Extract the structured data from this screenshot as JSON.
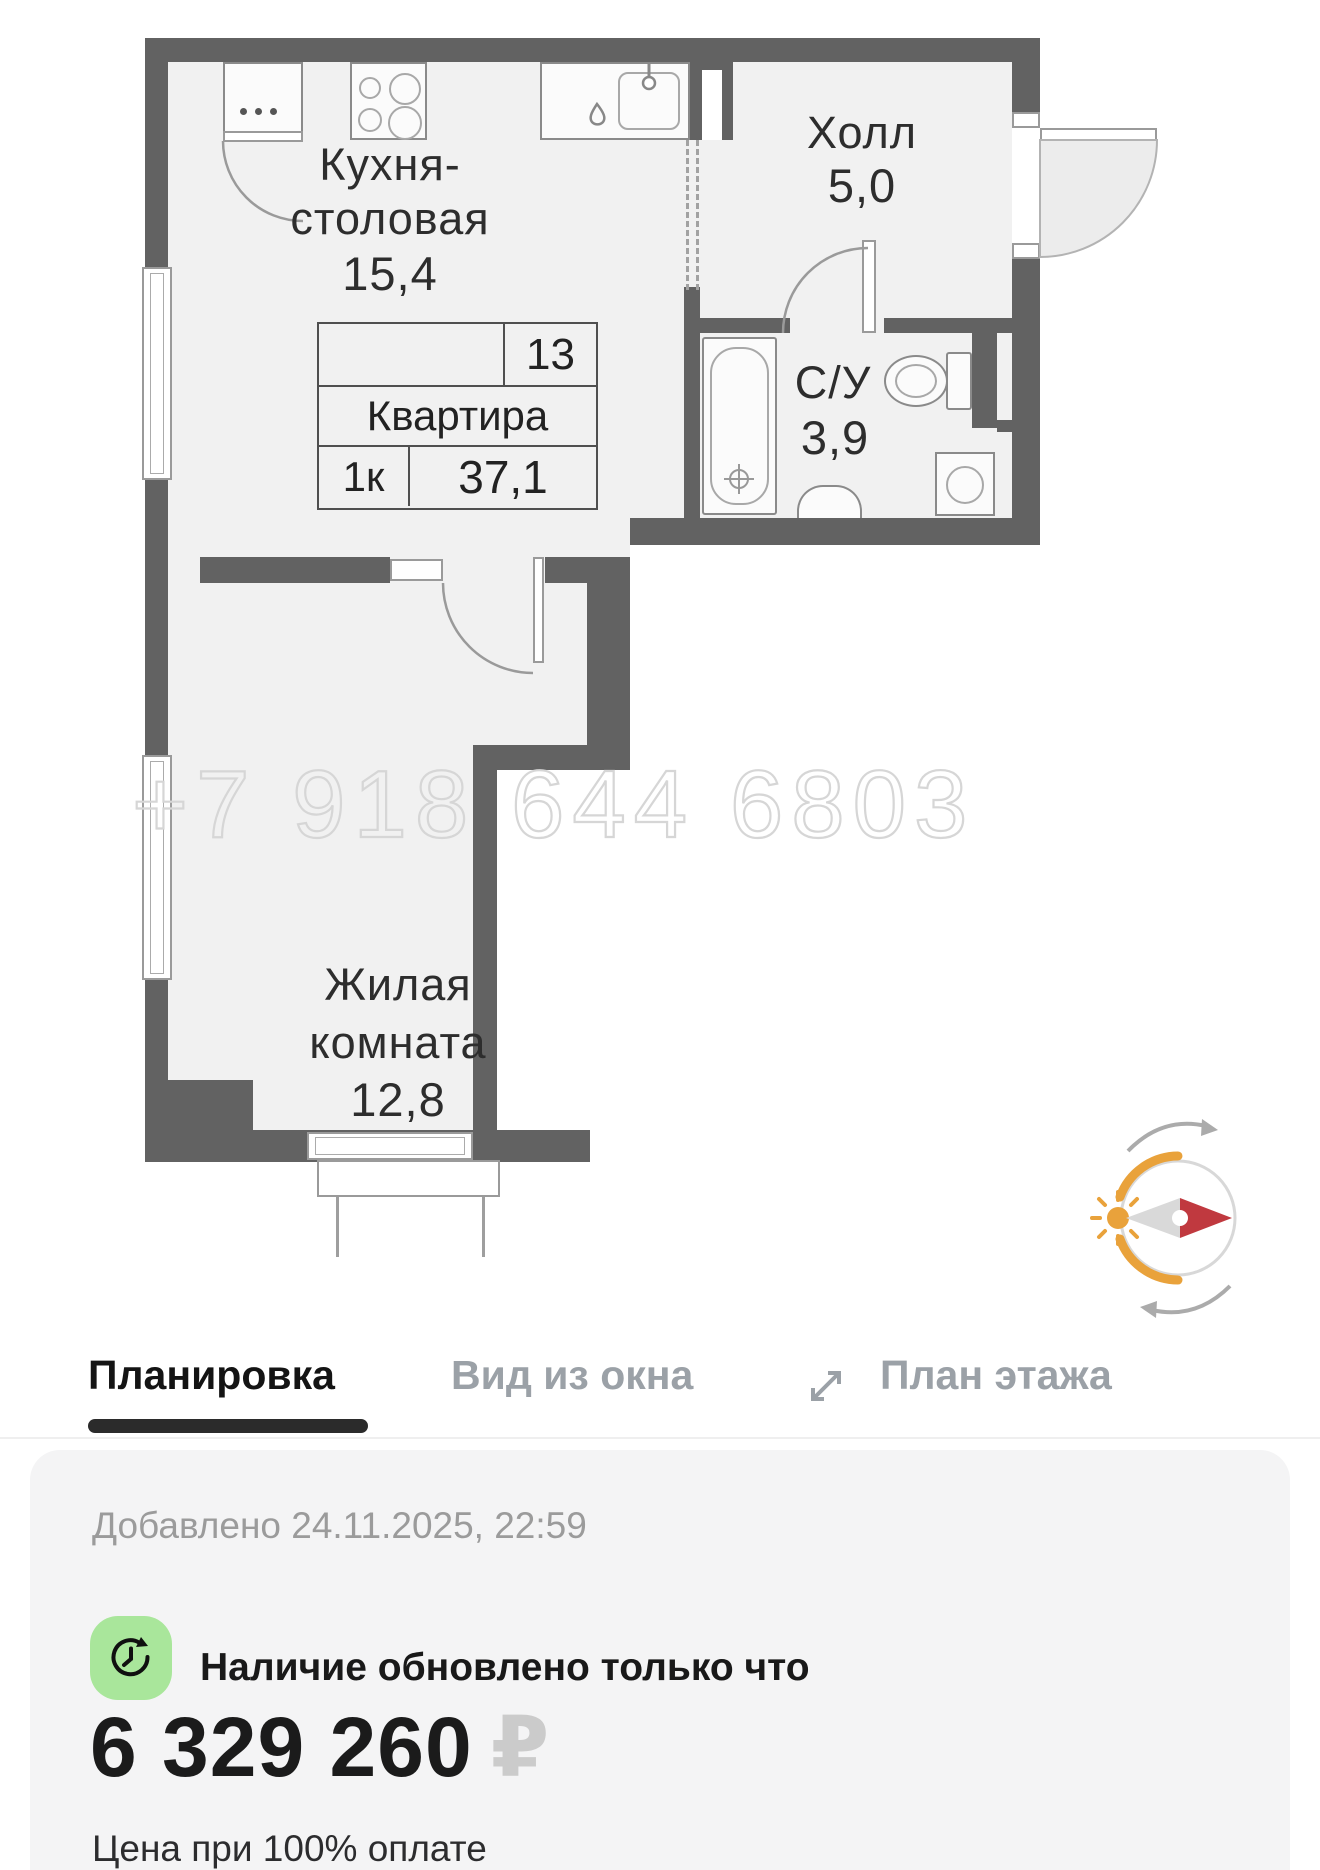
{
  "plan": {
    "watermark": "+7 918 644 6803",
    "rooms": {
      "kitchen": {
        "name_line1": "Кухня-",
        "name_line2": "столовая",
        "area": "15,4"
      },
      "hall": {
        "name": "Холл",
        "area": "5,0"
      },
      "bathroom": {
        "name": "С/У",
        "area": "3,9"
      },
      "living": {
        "name_line1": "Жилая",
        "name_line2": "комната",
        "area": "12,8"
      }
    },
    "info_table": {
      "floor": "13",
      "title": "Квартира",
      "rooms": "1к",
      "total_area": "37,1"
    },
    "icons": {
      "compass": "sun-direction-compass"
    }
  },
  "tabs": {
    "items": [
      {
        "label": "Планировка",
        "active": true
      },
      {
        "label": "Вид из окна",
        "active": false
      },
      {
        "label": "План этажа",
        "active": false
      }
    ]
  },
  "card": {
    "added_line": "Добавлено 24.11.2025, 22:59",
    "availability": "Наличие обновлено только что",
    "price": "6 329 260",
    "currency": "₽",
    "price_note": "Цена при 100% оплате"
  },
  "colors": {
    "wall": "#626262",
    "floor": "#f1f1f1",
    "accent_orange": "#e9a23b",
    "needle_red": "#c0393f",
    "green_badge": "#a9e69b",
    "active_tab": "#141414",
    "inactive_tab": "#9ba1a7"
  }
}
